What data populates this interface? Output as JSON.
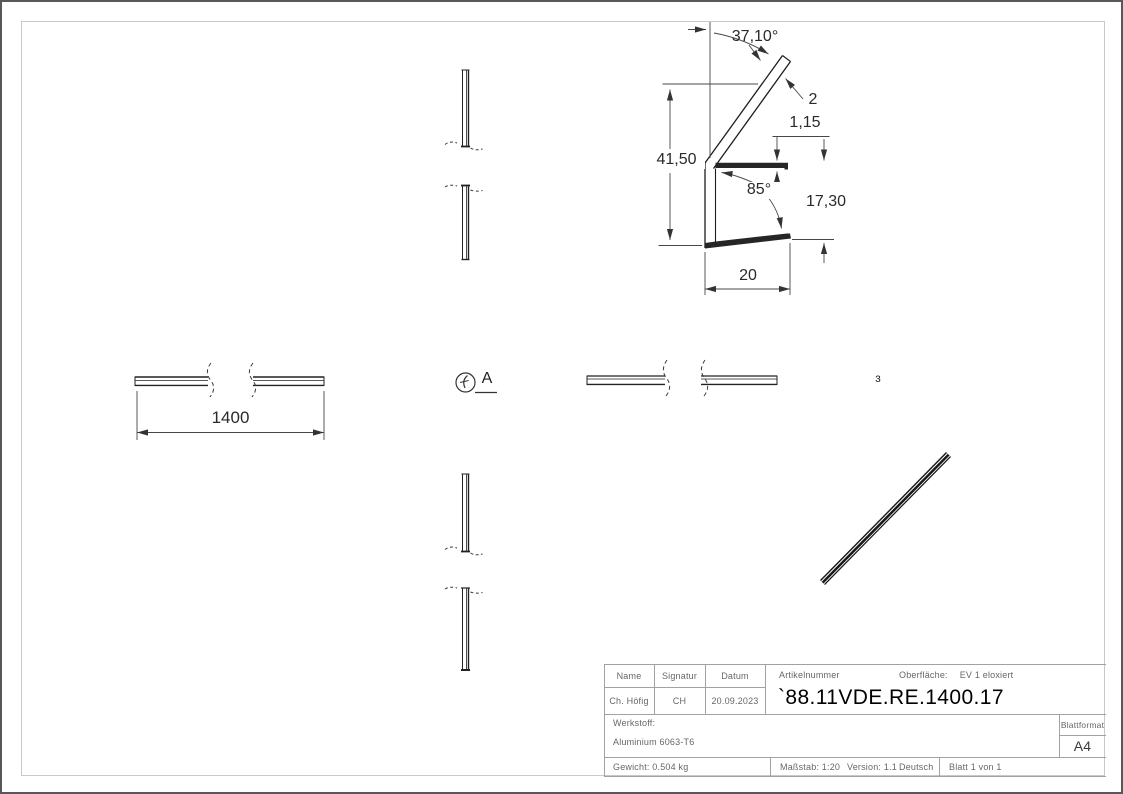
{
  "page": {
    "colors": {
      "outline": "#1d1d1d",
      "dimension": "#474747",
      "frame": "#c9c9c9",
      "table_border": "#a2a2a2",
      "table_text": "#676767"
    }
  },
  "dimensions": {
    "top_angle": "37,10°",
    "arm_thickness": "2",
    "flange_thickness": "1,15",
    "overall_height": "41,50",
    "inner_angle": "85°",
    "inner_height": "17,30",
    "width": "20",
    "length": "1400"
  },
  "callouts": {
    "detail_label": "A",
    "partial_glyph": "ɜ"
  },
  "title_block": {
    "headers": {
      "name": "Name",
      "signature": "Signatur",
      "date": "Datum",
      "article": "Artikelnummer",
      "surface_label": "Oberfläche:",
      "surface_value": "EV 1 eloxiert"
    },
    "values": {
      "name": "Ch. Höfig",
      "signature": "CH",
      "date": "20.09.2023",
      "article": "`88.11VDE.RE.1400.17"
    },
    "material_label": "Werkstoff:",
    "material_value": "Aluminium 6063-T6",
    "sheet_format_label": "Blattformat",
    "sheet_format_value": "A4",
    "weight": "Gewicht: 0.504 kg",
    "scale": "Maßstab: 1:20",
    "version": "Version: 1.1",
    "language": "Deutsch",
    "sheet": "Blatt 1 von 1"
  }
}
